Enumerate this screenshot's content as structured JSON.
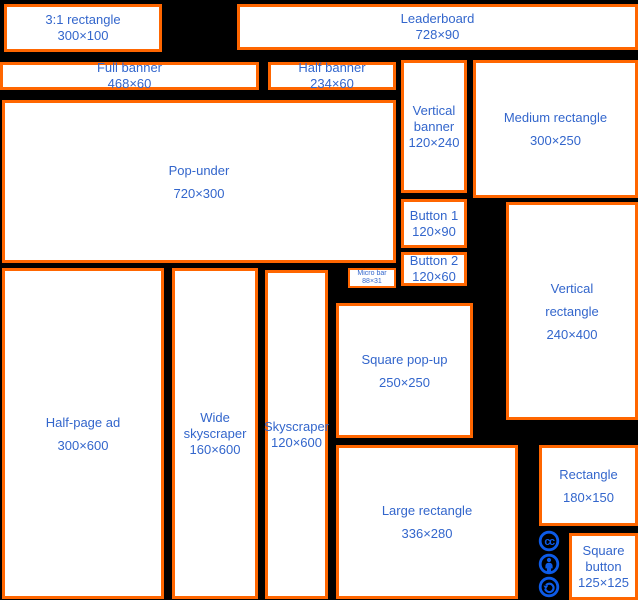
{
  "diagram": {
    "description": "Standard web banner ad sizes",
    "colors": {
      "background": "#000000",
      "box_fill": "#ffffff",
      "box_border": "#ff6600",
      "label_text": "#3366cc",
      "license_icons": "#0d5be8"
    }
  },
  "boxes": {
    "ratio_rectangle": {
      "lines": [
        "3:1 rectangle"
      ],
      "size": "300×100"
    },
    "leaderboard": {
      "lines": [
        "Leaderboard"
      ],
      "size": "728×90"
    },
    "full_banner": {
      "lines": [
        "Full banner"
      ],
      "size": "468×60"
    },
    "half_banner": {
      "lines": [
        "Half banner"
      ],
      "size": "234×60"
    },
    "vertical_banner": {
      "lines": [
        "Vertical",
        "banner"
      ],
      "size": "120×240"
    },
    "medium_rectangle": {
      "lines": [
        "Medium rectangle"
      ],
      "size": "300×250"
    },
    "button_1": {
      "lines": [
        "Button 1"
      ],
      "size": "120×90"
    },
    "button_2": {
      "lines": [
        "Button 2"
      ],
      "size": "120×60"
    },
    "pop_under": {
      "lines": [
        "Pop-under"
      ],
      "size": "720×300"
    },
    "micro_bar": {
      "lines": [
        "Micro bar"
      ],
      "size": "88×31"
    },
    "half_page_ad": {
      "lines": [
        "Half-page ad"
      ],
      "size": "300×600"
    },
    "wide_skyscraper": {
      "lines": [
        "Wide",
        "skyscraper"
      ],
      "size": "160×600"
    },
    "skyscraper": {
      "lines": [
        "Skyscraper"
      ],
      "size": "120×600"
    },
    "square_popup": {
      "lines": [
        "Square pop-up"
      ],
      "size": "250×250"
    },
    "large_rectangle": {
      "lines": [
        "Large rectangle"
      ],
      "size": "336×280"
    },
    "vertical_rectangle": {
      "lines": [
        "Vertical",
        "rectangle"
      ],
      "size": "240×400"
    },
    "rectangle": {
      "lines": [
        "Rectangle"
      ],
      "size": "180×150"
    },
    "square_button": {
      "lines": [
        "Square",
        "button"
      ],
      "size": "125×125"
    }
  },
  "icons": {
    "cc": "cc-logo-icon",
    "attribution": "cc-attribution-icon",
    "share_alike": "cc-share-alike-icon"
  }
}
